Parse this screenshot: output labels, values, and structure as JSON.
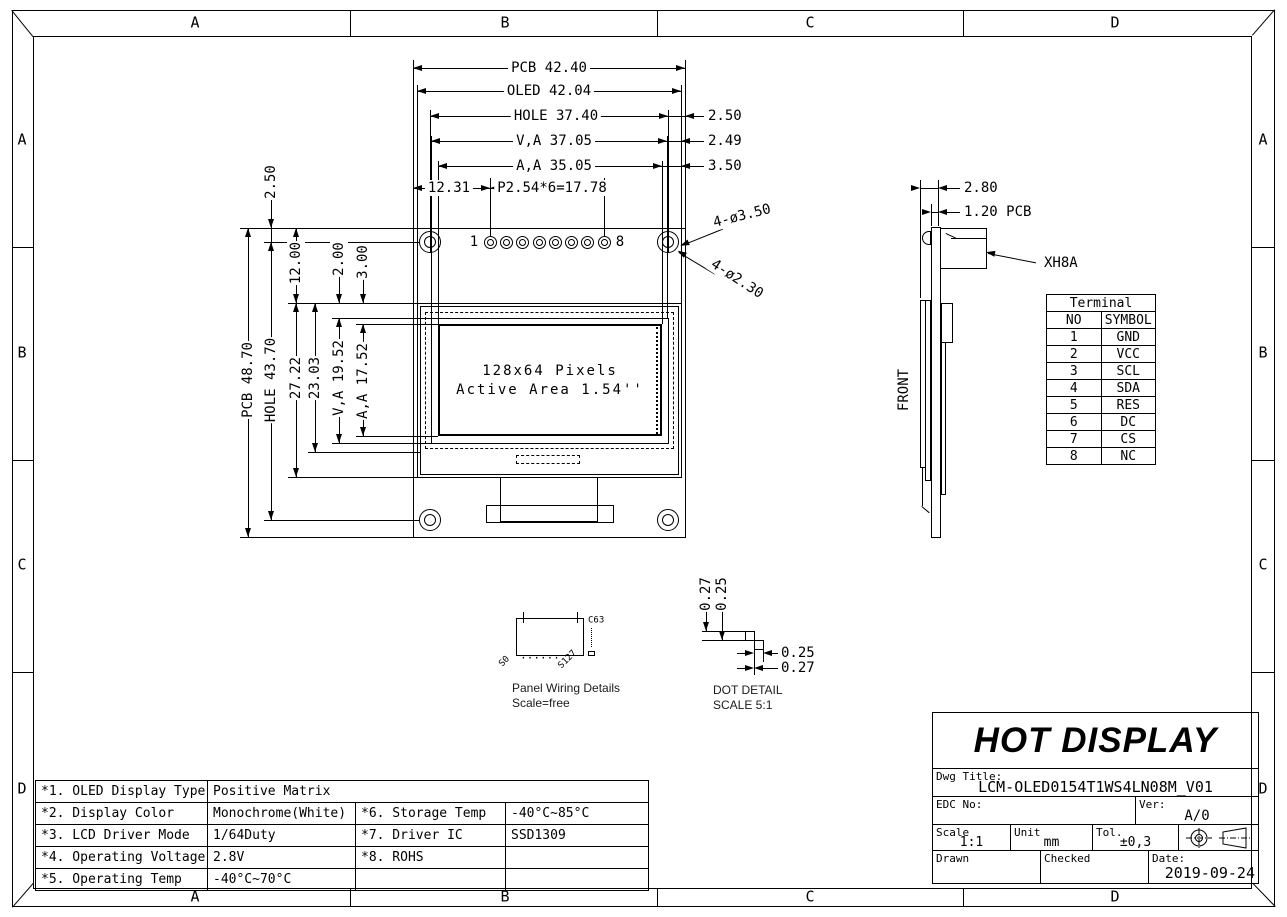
{
  "drawing": {
    "zones": [
      "A",
      "B",
      "C",
      "D"
    ],
    "front_view": {
      "dim_pcb_w": "PCB 42.40",
      "dim_oled_w": "OLED 42.04",
      "dim_hole_w": "HOLE 37.40",
      "dim_va_w": "V,A 37.05",
      "dim_aa_w": "A,A 35.05",
      "dim_pin_offset": "12.31",
      "dim_pin_pitch": "P2.54*6=17.78",
      "dim_edge_hole": "2.50",
      "dim_edge_va": "2.49",
      "dim_edge_aa": "3.50",
      "dim_top_edge": "2.50",
      "dim_pcb_h": "PCB 48.70",
      "dim_hole_h": "HOLE 43.70",
      "dim_glass_top": "12.00",
      "dim_glass_h": "27.22",
      "dim_inner_h": "23.03",
      "dim_va_top": "2.00",
      "dim_aa_top": "3.00",
      "dim_va_h": "V,A 19.52",
      "dim_aa_h": "A,A 17.52",
      "note_hole_outer": "4-ø3.50",
      "note_hole_inner": "4-ø2.30",
      "pin_first": "1",
      "pin_last": "8",
      "display_line1": "128x64 Pixels",
      "display_line2": "Active Area 1.54''"
    },
    "side_view": {
      "dim_total": "2.80",
      "dim_pcb": "1.20 PCB",
      "connector_label": "XH8A",
      "front_label": "FRONT"
    },
    "panel_wiring": {
      "com_top": "C63",
      "seg_left": "S0",
      "seg_right": "S127",
      "dots": "......",
      "caption1": "Panel Wiring Details",
      "caption2": "Scale=free"
    },
    "dot_detail": {
      "dim_v1": "0.27",
      "dim_v2": "0.25",
      "dim_h1": "0.25",
      "dim_h2": "0.27",
      "caption1": "DOT DETAIL",
      "caption2": "SCALE 5:1"
    }
  },
  "terminal_table": {
    "title": "Terminal",
    "col_no": "NO",
    "col_symbol": "SYMBOL",
    "rows": [
      {
        "no": "1",
        "symbol": "GND"
      },
      {
        "no": "2",
        "symbol": "VCC"
      },
      {
        "no": "3",
        "symbol": "SCL"
      },
      {
        "no": "4",
        "symbol": "SDA"
      },
      {
        "no": "5",
        "symbol": "RES"
      },
      {
        "no": "6",
        "symbol": "DC"
      },
      {
        "no": "7",
        "symbol": "CS"
      },
      {
        "no": "8",
        "symbol": "NC"
      }
    ]
  },
  "spec_table": {
    "rows": [
      {
        "c1": "*1. OLED Display Type",
        "c2": "Positive Matrix",
        "c3": "",
        "c4": ""
      },
      {
        "c1": "*2. Display Color",
        "c2": "Monochrome(White)",
        "c3": "*6. Storage Temp",
        "c4": "-40°C~85°C"
      },
      {
        "c1": "*3. LCD Driver Mode",
        "c2": "1/64Duty",
        "c3": "*7. Driver IC",
        "c4": "SSD1309"
      },
      {
        "c1": "*4. Operating Voltage",
        "c2": "2.8V",
        "c3": "*8. ROHS",
        "c4": ""
      },
      {
        "c1": "*5. Operating Temp",
        "c2": "-40°C~70°C",
        "c3": "",
        "c4": ""
      }
    ]
  },
  "title_block": {
    "company": "HOT DISPLAY",
    "dwg_title_label": "Dwg Title:",
    "dwg_title": "LCM-OLED0154T1WS4LN08M_V01",
    "edc_label": "EDC No:",
    "ver_label": "Ver:",
    "version": "A/0",
    "scale_label": "Scale",
    "scale_value": "1:1",
    "unit_label": "Unit",
    "unit_value": "mm",
    "tol_label": "Tol.",
    "tol_value": "±0,3",
    "drawn_label": "Drawn",
    "checked_label": "Checked",
    "date_label": "Date:",
    "date_value": "2019-09-24"
  }
}
